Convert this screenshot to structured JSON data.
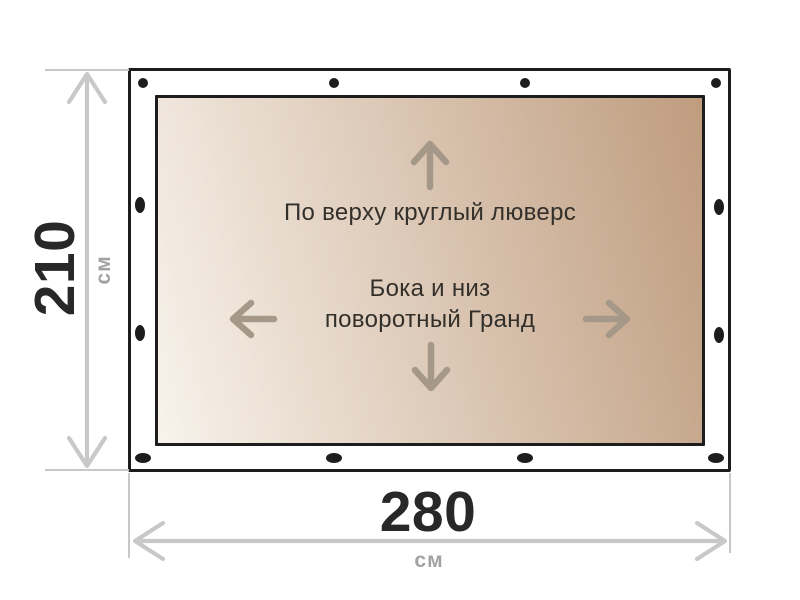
{
  "dimensions": {
    "height": {
      "value": "210",
      "unit": "см"
    },
    "width": {
      "value": "280",
      "unit": "см"
    }
  },
  "annotations": {
    "top_edge": "По верху круглый люверс",
    "sides_line1": "Бока и низ",
    "sides_line2": "поворотный Гранд"
  },
  "fasteners": {
    "top": {
      "type": "round-grommet",
      "count": 4
    },
    "left": {
      "type": "oval-grand-fastener",
      "count": 2
    },
    "right": {
      "type": "oval-grand-fastener",
      "count": 2
    },
    "bottom": {
      "type": "oval-grand-fastener",
      "count": 4
    }
  },
  "colors": {
    "outline": "#1d1d1d",
    "fastener": "#1d1d1d",
    "canvas_light": "#f8f3ec",
    "canvas_dark": "#bf9c7e",
    "direction_arrow": "#a69888",
    "annotation_text": "#33302b",
    "dimension_line": "#c8c8c8",
    "dimension_value": "#282828",
    "dimension_unit": "#a2a2a2"
  }
}
